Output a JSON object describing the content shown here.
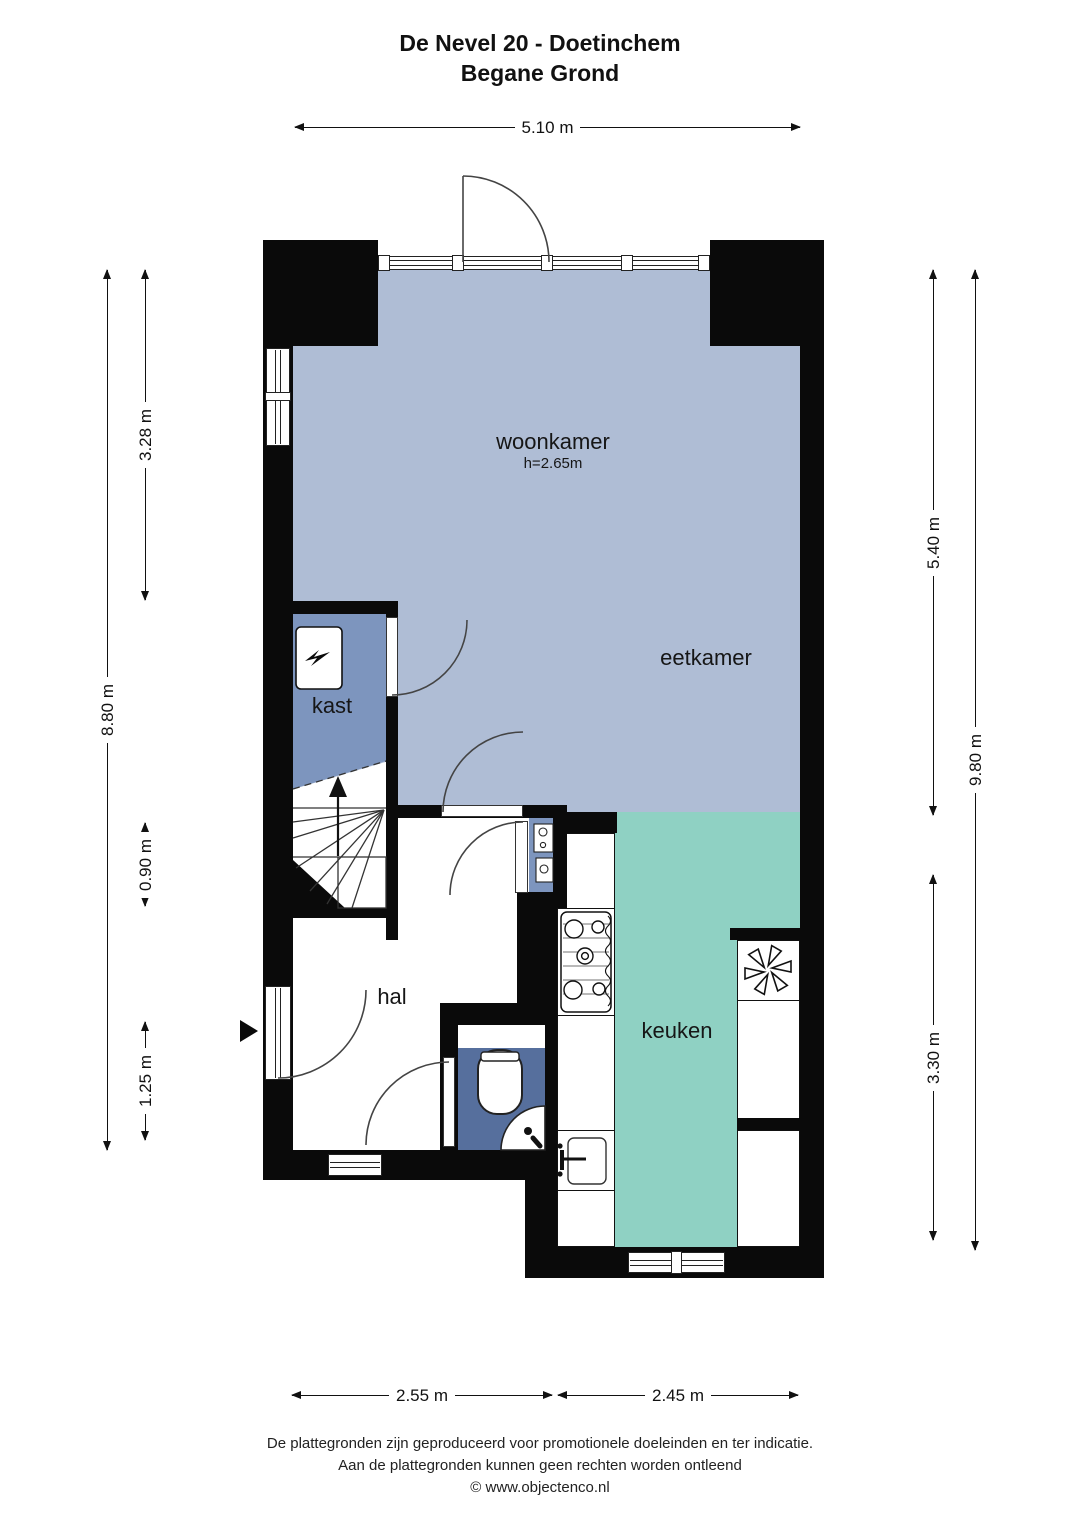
{
  "title": {
    "line1": "De Nevel 20 - Doetinchem",
    "line2": "Begane Grond"
  },
  "rooms": {
    "woonkamer": {
      "label": "woonkamer",
      "height_note": "h=2.65m"
    },
    "eetkamer": {
      "label": "eetkamer"
    },
    "kast": {
      "label": "kast"
    },
    "hal": {
      "label": "hal"
    },
    "keuken": {
      "label": "keuken"
    }
  },
  "dimensions": {
    "top_width": "5.10 m",
    "left_total": "8.80 m",
    "left_upper": "3.28 m",
    "left_middle": "0.90 m",
    "left_lower": "1.25 m",
    "right_total": "9.80 m",
    "right_upper": "5.40 m",
    "right_lower": "3.30 m",
    "bottom_left": "2.55 m",
    "bottom_right": "2.45 m"
  },
  "footer": {
    "line1": "De plattegronden zijn geproduceerd voor promotionele doeleinden en ter indicatie.",
    "line2": "Aan de plattegronden kunnen geen rechten worden ontleend",
    "line3": "© www.objectenco.nl"
  },
  "colors": {
    "living_area_fill": "#afbdd5",
    "closet_fill": "#7d95be",
    "kitchen_fill": "#8fd1c3",
    "toilet_fill": "#566f9d",
    "wall": "#0a0a0a"
  },
  "icons": [
    "flame-icon",
    "fan-icon",
    "stove-icon",
    "sink-icon",
    "toilet-icon",
    "corner-sink-icon",
    "entrance-arrow-icon",
    "stairs-up-arrow-icon",
    "meter-cabinet-icon"
  ]
}
